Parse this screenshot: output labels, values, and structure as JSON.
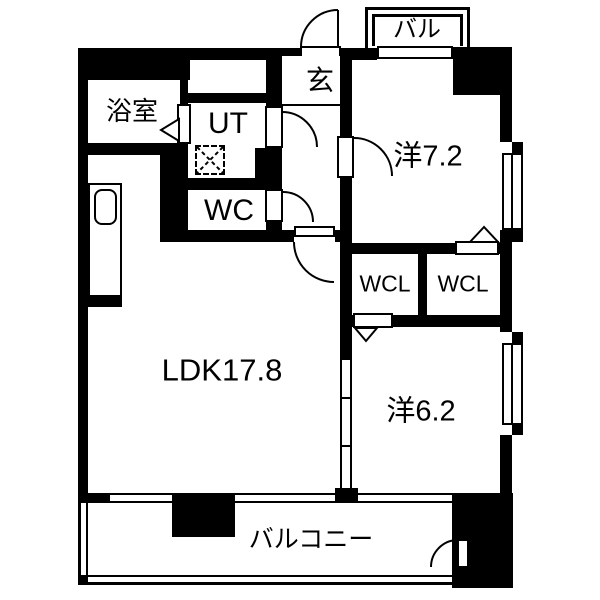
{
  "plan": {
    "type": "japanese-apartment-floorplan",
    "rooms": [
      {
        "name": "bathroom",
        "label": "浴室"
      },
      {
        "name": "utility",
        "label": "UT"
      },
      {
        "name": "toilet",
        "label": "WC"
      },
      {
        "name": "entrance",
        "label": "玄"
      },
      {
        "name": "balcony-upper",
        "label": "バル"
      },
      {
        "name": "western-room-7-2",
        "label": "洋7.2"
      },
      {
        "name": "closet-left",
        "label": "WCL"
      },
      {
        "name": "closet-right",
        "label": "WCL"
      },
      {
        "name": "ldk",
        "label": "LDK17.8"
      },
      {
        "name": "western-room-6-2",
        "label": "洋6.2"
      },
      {
        "name": "balcony",
        "label": "バルコニー"
      },
      {
        "name": "storage",
        "label": "収"
      }
    ],
    "fixtures": [
      {
        "name": "kitchen-sink"
      },
      {
        "name": "washing-machine-space"
      }
    ],
    "colors": {
      "wall": "#000000",
      "floor": "#ffffff"
    }
  }
}
